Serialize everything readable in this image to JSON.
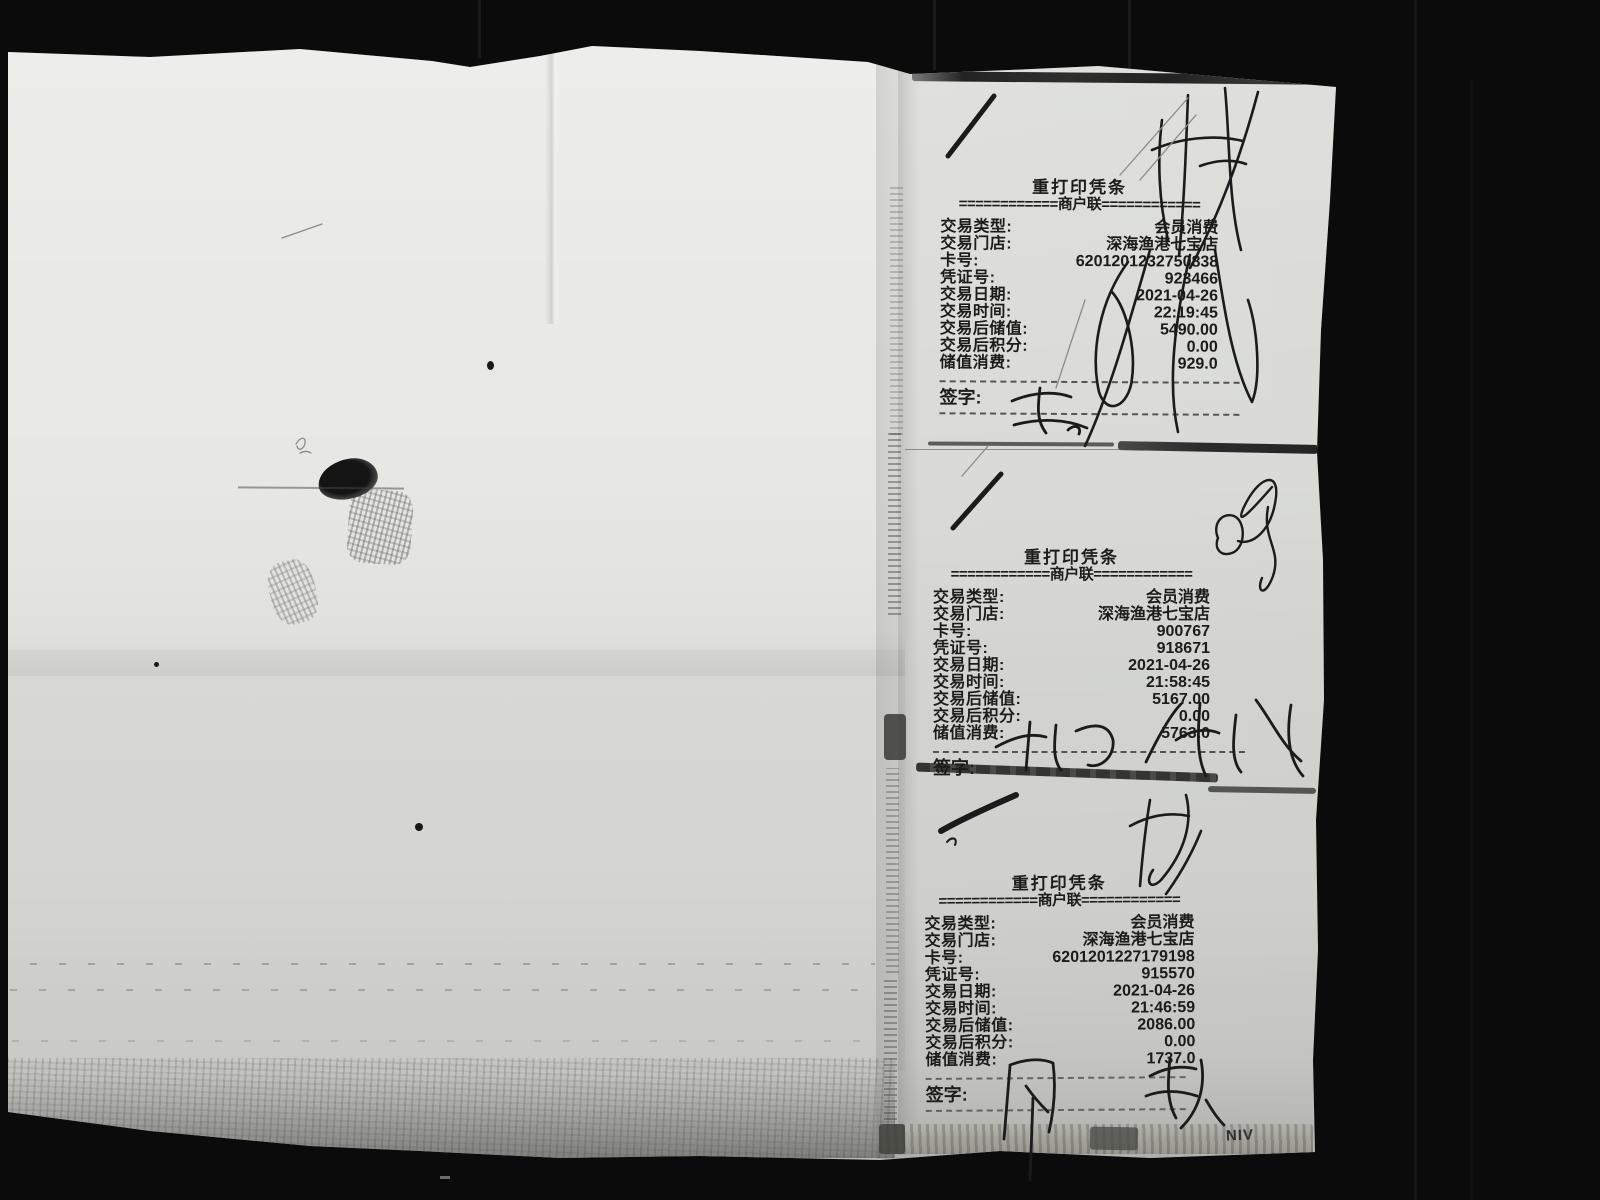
{
  "colors": {
    "background": "#0b0b0b",
    "paper": "#e7e8e4",
    "receipt_strip": "#d9dad6",
    "printed_ink": "#1c1c1c",
    "pen_ink": "#1b1b1b"
  },
  "receipts": [
    {
      "title": "重打印凭条",
      "copy_line": "============商户联============",
      "rows": [
        {
          "label": "交易类型:",
          "value": "会员消费"
        },
        {
          "label": "交易门店:",
          "value": "深海渔港七宝店"
        },
        {
          "label": "卡号:",
          "value": "6201201232750838"
        },
        {
          "label": "凭证号:",
          "value": "923466"
        },
        {
          "label": "交易日期:",
          "value": "2021-04-26"
        },
        {
          "label": "交易时间:",
          "value": "22:19:45"
        },
        {
          "label": "交易后储值:",
          "value": "5490.00"
        },
        {
          "label": "交易后积分:",
          "value": "0.00"
        },
        {
          "label": "储值消费:",
          "value": "929.0"
        }
      ],
      "sign_label": "签字:"
    },
    {
      "title": "重打印凭条",
      "copy_line": "============商户联============",
      "rows": [
        {
          "label": "交易类型:",
          "value": "会员消费"
        },
        {
          "label": "交易门店:",
          "value": "深海渔港七宝店"
        },
        {
          "label": "卡号:",
          "value": "900767"
        },
        {
          "label": "凭证号:",
          "value": "918671"
        },
        {
          "label": "交易日期:",
          "value": "2021-04-26"
        },
        {
          "label": "交易时间:",
          "value": "21:58:45"
        },
        {
          "label": "交易后储值:",
          "value": "5167.00"
        },
        {
          "label": "交易后积分:",
          "value": "0.00"
        },
        {
          "label": "储值消费:",
          "value": "5763.0"
        }
      ],
      "sign_label": "签字:"
    },
    {
      "title": "重打印凭条",
      "copy_line": "============商户联============",
      "rows": [
        {
          "label": "交易类型:",
          "value": "会员消费"
        },
        {
          "label": "交易门店:",
          "value": "深海渔港七宝店"
        },
        {
          "label": "卡号:",
          "value": "6201201227179198"
        },
        {
          "label": "凭证号:",
          "value": "915570"
        },
        {
          "label": "交易日期:",
          "value": "2021-04-26"
        },
        {
          "label": "交易时间:",
          "value": "21:46:59"
        },
        {
          "label": "交易后储值:",
          "value": "2086.00"
        },
        {
          "label": "交易后积分:",
          "value": "0.00"
        },
        {
          "label": "储值消费:",
          "value": "1737.0"
        }
      ],
      "sign_label": "签字:"
    }
  ],
  "artifacts": {
    "stamp_fragment": "NIV"
  }
}
